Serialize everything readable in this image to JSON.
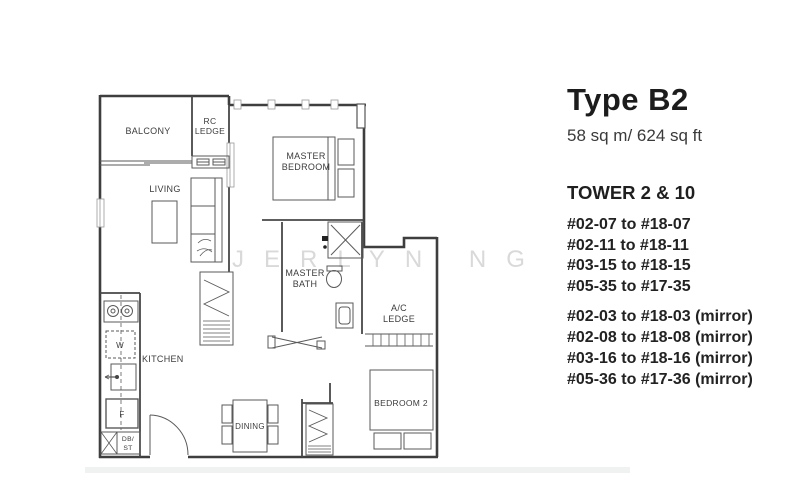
{
  "plan": {
    "watermark": "JERLYN NG",
    "rooms": {
      "balcony": "BALCONY",
      "rc_ledge": [
        "RC",
        "LEDGE"
      ],
      "living": "LIVING",
      "master_bedroom": [
        "MASTER",
        "BEDROOM"
      ],
      "master_bath": [
        "MASTER",
        "BATH"
      ],
      "ac_ledge": [
        "A/C",
        "LEDGE"
      ],
      "kitchen": "KITCHEN",
      "dining": "DINING",
      "bedroom2": "BEDROOM 2",
      "db_st": [
        "DB/",
        "ST"
      ],
      "washer": "W",
      "fridge": "F"
    }
  },
  "panel": {
    "title": "Type B2",
    "area": "58 sq m/ 624 sq ft",
    "tower": "TOWER 2 & 10",
    "units": [
      "#02-07 to #18-07",
      "#02-11 to #18-11",
      "#03-15 to #18-15",
      "#05-35 to #17-35"
    ],
    "units_mirror": [
      "#02-03 to #18-03 (mirror)",
      "#02-08 to #18-08 (mirror)",
      "#03-16 to #18-16 (mirror)",
      "#05-36 to #17-36 (mirror)"
    ]
  },
  "colors": {
    "wall_line": "#3e3e3e",
    "furniture_line": "#5a5a5a",
    "label_text": "#3c3c3c",
    "panel_text": "#1f1f1f",
    "watermark": "#d9d9d9",
    "background": "#ffffff"
  }
}
